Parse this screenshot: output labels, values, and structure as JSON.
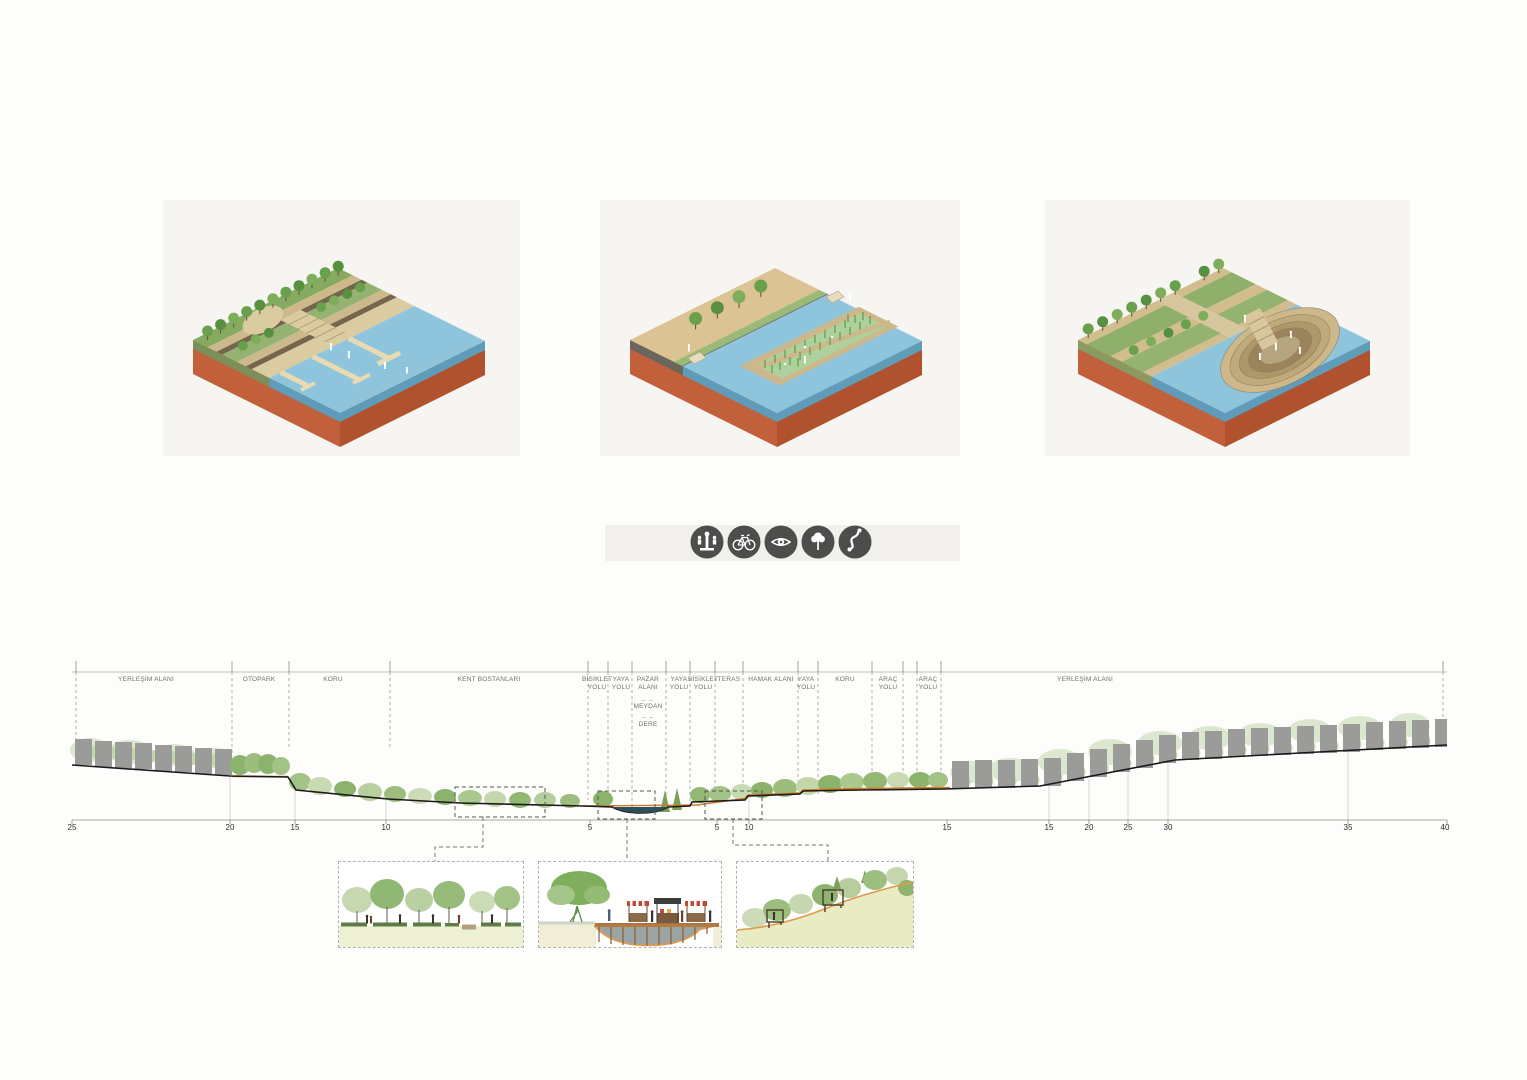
{
  "palette": {
    "terracotta_light": "#c2603c",
    "terracotta_dark": "#b0522e",
    "water_top": "#8ec5dd",
    "water_edge": "#5f9cb9",
    "land_tan": "#d9c193",
    "walk_pale": "#dbcba1",
    "tree_green": "#68a04b",
    "section_line": "#1a1a1a",
    "road_orange": "#d07828",
    "icon_circle": "#4d4d4b",
    "detail_ground": "#edf0d2"
  },
  "legend": {
    "icons": [
      {
        "name": "fountain-market-icon"
      },
      {
        "name": "bicycle-icon"
      },
      {
        "name": "eye-icon"
      },
      {
        "name": "tree-icon"
      },
      {
        "name": "winding-path-icon"
      }
    ]
  },
  "section": {
    "zones": [
      {
        "label": "YERLEŞİM ALANI"
      },
      {
        "label": "OTOPARK"
      },
      {
        "label": "KORU"
      },
      {
        "label": "KENT BOSTANLARI"
      },
      {
        "label": "BİSİKLET\nYOLU"
      },
      {
        "label": "YAYA\nYOLU"
      },
      {
        "label": "PAZAR\nALANI"
      },
      {
        "label": "MEYDAN"
      },
      {
        "label": "DERE"
      },
      {
        "label": "YAYA\nYOLU"
      },
      {
        "label": "BİSİKLET\nYOLU"
      },
      {
        "label": "TERAS"
      },
      {
        "label": "HAMAK ALANI"
      },
      {
        "label": "YAYA\nYOLU"
      },
      {
        "label": "KORU"
      },
      {
        "label": "ARAÇ\nYOLU"
      },
      {
        "label": "ARAÇ\nYOLU"
      },
      {
        "label": "YERLEŞİM ALANI"
      }
    ],
    "separator": "– –",
    "axis_ticks": [
      "25",
      "20",
      "15",
      "10",
      "5",
      "5",
      "10",
      "15",
      "15",
      "20",
      "25",
      "30",
      "35",
      "40"
    ]
  }
}
